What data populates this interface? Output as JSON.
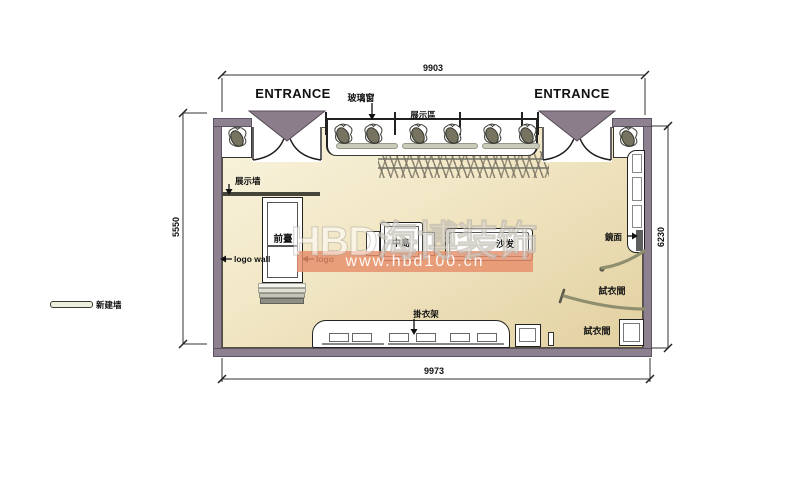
{
  "plan": {
    "entrance_left": "ENTRANCE",
    "entrance_right": "ENTRANCE",
    "labels": {
      "glass_window": "玻璃窗",
      "display_area": "展示區",
      "display_wall": "展示墙",
      "front_desk": "前臺",
      "logo_wall": "logo wall",
      "logo": "logo",
      "center_island": "中島",
      "sofa": "沙发",
      "hanging_rack": "掛衣架",
      "mirror": "鏡面",
      "fitting_room_top": "試衣間",
      "fitting_room_bottom": "試衣間",
      "new_wall_legend": "新建墙"
    },
    "dimensions": {
      "top": "9903",
      "bottom": "9973",
      "left": "5550",
      "right": "6230"
    }
  },
  "watermark": {
    "brand": "HBD海博装饰",
    "url": "www.hbd100.cn",
    "band_color": "#e78d6a"
  },
  "colors": {
    "wall": "#8d8190",
    "floor_light": "#f9f4de",
    "floor_dark": "#e2d0a0",
    "canopy": "#8b7d89"
  }
}
